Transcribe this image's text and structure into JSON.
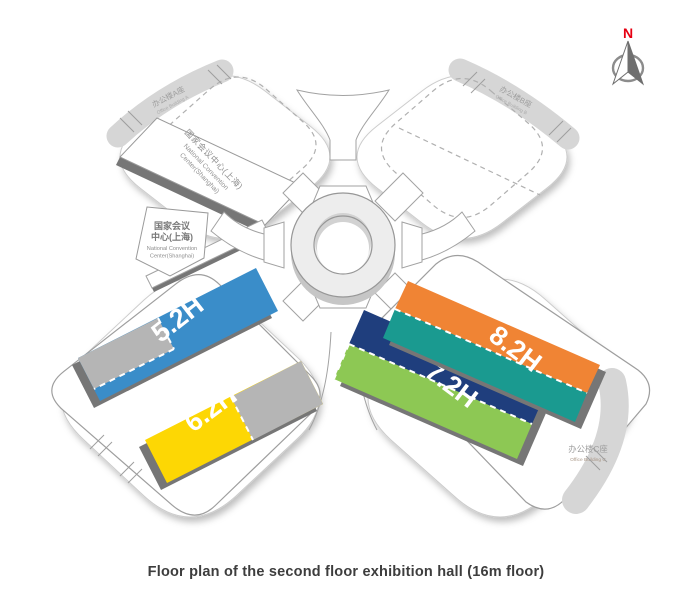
{
  "caption": "Floor plan of the second floor exhibition hall (16m floor)",
  "compass": {
    "north_label": "N",
    "north_color": "#e60012"
  },
  "center_landmark": {
    "name_cn_line1": "国家会议",
    "name_cn_line2": "中心(上海)",
    "name_en_line1": "National Convention",
    "name_en_line2": "Center(Shanghai)"
  },
  "convention_center_panel": {
    "name_cn": "国家会议中心(上海)",
    "name_en_line1": "National Convention",
    "name_en_line2": "Center(Shanghai)"
  },
  "office_buildings": [
    {
      "name_cn": "办公楼A座",
      "name_en": "Office Building A"
    },
    {
      "name_cn": "办公楼B座",
      "name_en": "Office Building B"
    },
    {
      "name_cn": "办公楼C座",
      "name_en": "Office Building C"
    }
  ],
  "halls": [
    {
      "label": "5.2H",
      "primary_color": "#3a8dc9",
      "secondary_color": "#b5b5b5"
    },
    {
      "label": "6.2H",
      "primary_color": "#fdd704",
      "secondary_color": "#b5b5b5"
    },
    {
      "label": "7.2H",
      "primary_color": "#1f3e7d",
      "secondary_color": "#8dc854"
    },
    {
      "label": "8.2H",
      "primary_color": "#f08434",
      "secondary_color": "#1a9a90"
    }
  ],
  "colors": {
    "office_band": "#d6d6d6",
    "edge_dark": "#767676",
    "outline": "#9b9b9b",
    "ring_fill": "#ededed"
  }
}
